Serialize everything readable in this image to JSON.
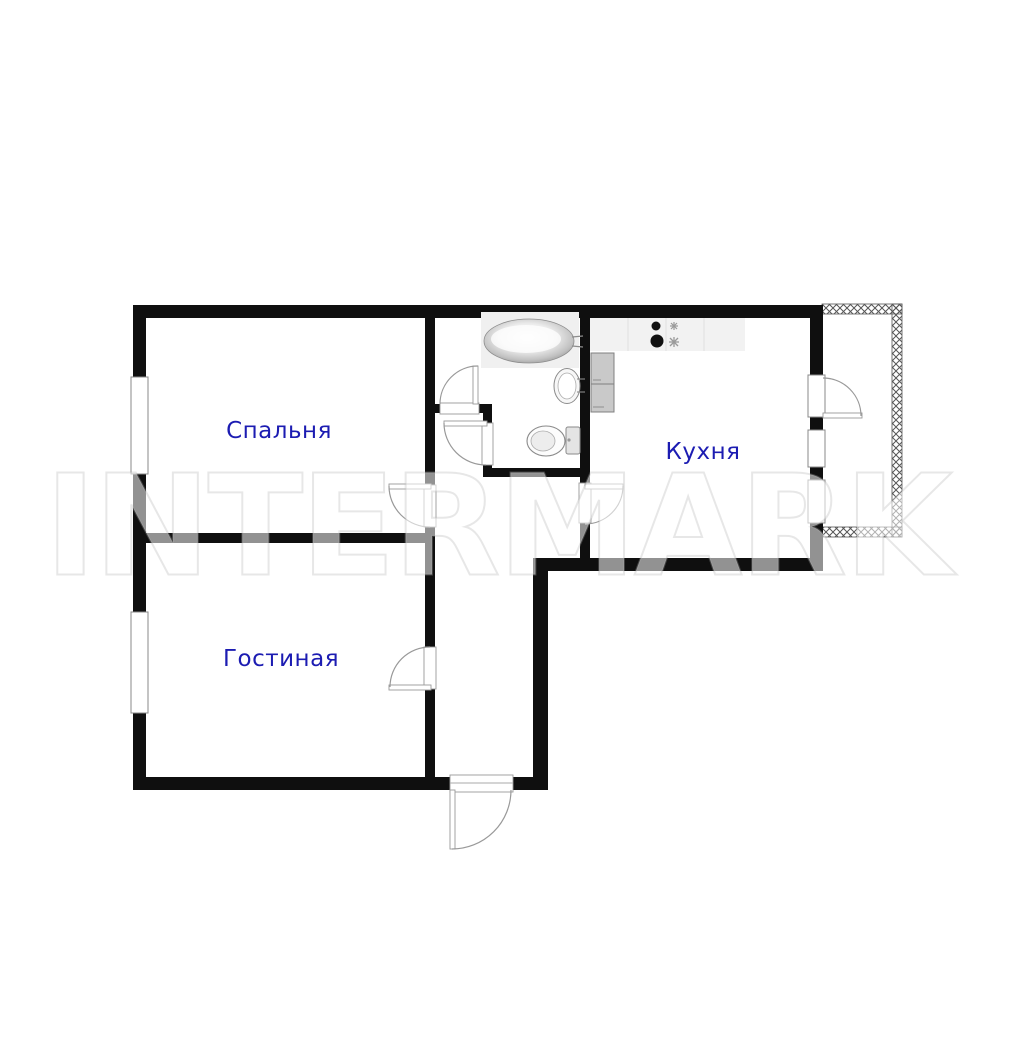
{
  "floorplan": {
    "watermark": "INTERMARK",
    "rooms": [
      {
        "id": "bedroom",
        "label": "Спальня"
      },
      {
        "id": "living-room",
        "label": "Гостиная"
      },
      {
        "id": "kitchen",
        "label": "Кухня"
      }
    ],
    "colors": {
      "wall": "#0f0f0f",
      "room_label": "#1c1cb2",
      "fixture_stroke": "#8a8a8a",
      "counter_fill": "#f2f2f2",
      "fridge_fill": "#c9c9c9",
      "background": "#ffffff"
    },
    "icons": [
      "bathtub-icon",
      "washbasin-icon",
      "toilet-icon",
      "stove-burners-icon",
      "fridge-icon",
      "kitchen-counter-icon",
      "balcony-railing-hatch",
      "door-arc",
      "window-frame"
    ]
  }
}
